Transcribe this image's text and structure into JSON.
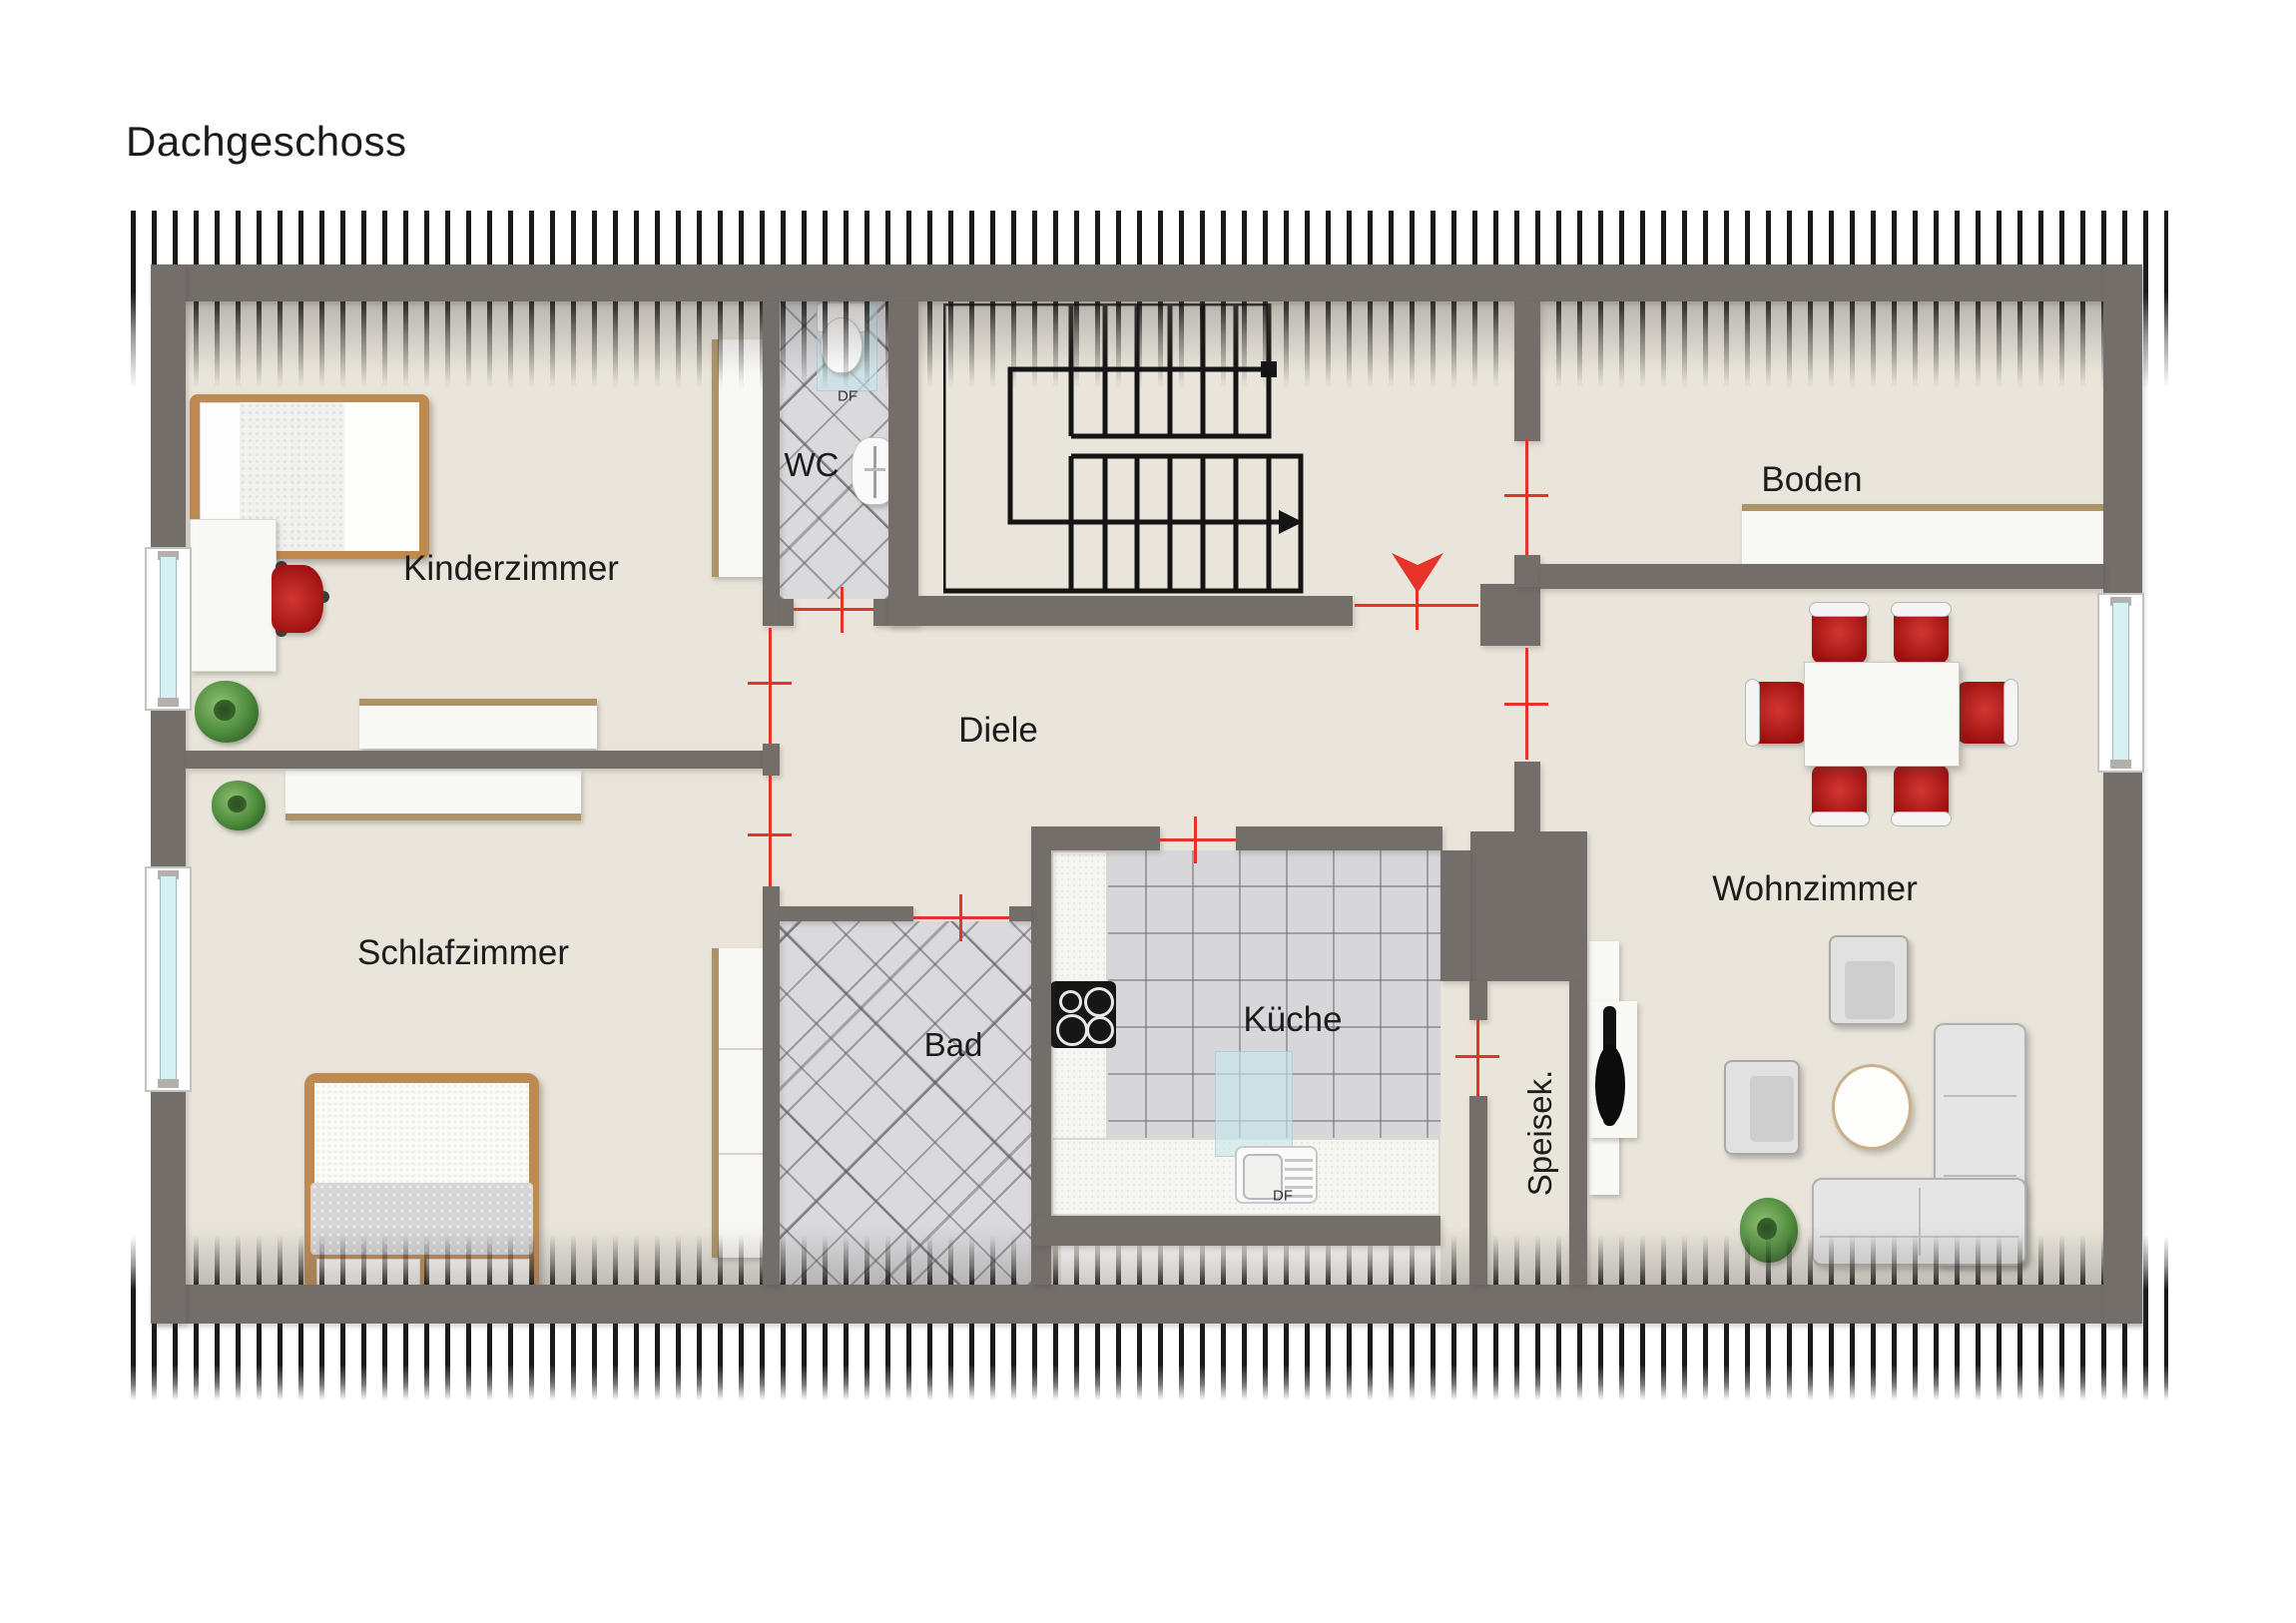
{
  "title": "Dachgeschoss",
  "plan": {
    "rooms": {
      "kinderzimmer": {
        "label": "Kinderzimmer"
      },
      "schlafzimmer": {
        "label": "Schlafzimmer"
      },
      "wc": {
        "label": "WC",
        "skylight_label": "DF"
      },
      "bad": {
        "label": "Bad"
      },
      "diele": {
        "label": "Diele"
      },
      "kueche": {
        "label": "Küche",
        "skylight_label": "DF"
      },
      "speisekammer": {
        "label": "Speisek."
      },
      "wohnzimmer": {
        "label": "Wohnzimmer"
      },
      "boden": {
        "label": "Boden"
      }
    },
    "colors": {
      "wall": "#746e6b",
      "floor": "#e9e5db",
      "door_marker": "#e5332a",
      "tile_floor": "#d9d9dc",
      "wood": "#bf8a52",
      "chair_red": "#b81717",
      "window_glass": "#d6f0f4"
    },
    "entrance_marker": "red-arrow-down"
  }
}
